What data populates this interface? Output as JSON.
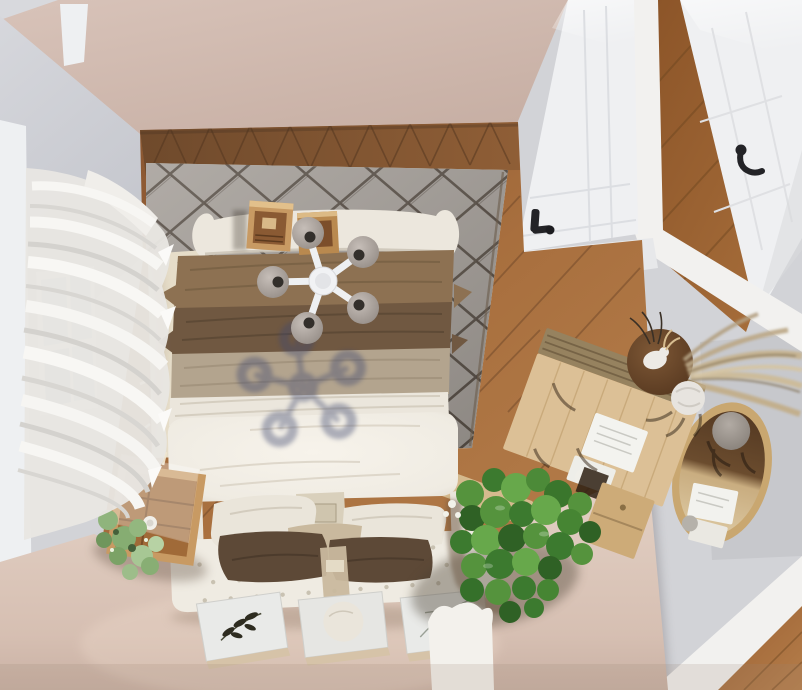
{
  "scene": {
    "view": "top-down 3d render of a bedroom",
    "colors": {
      "outside_floor": "#d2d3d7",
      "outside_floor_light": "#c7c8cc",
      "outside_shadow": "#a7a6aa",
      "wall_band": "#f2f1ef",
      "north_wall": "#cfb9ae",
      "left_wall": "#cdced5",
      "window_frame": "#eef0f2",
      "window_glass": "#a9c3d8",
      "curtain": "#e8e6e2",
      "wood_floor": "#9c6234",
      "wood_floor_dark": "#6f4a2c",
      "hall_wood": "#9a6030",
      "rug_grey": "#a49e98",
      "rug_cream": "#e6ddc9",
      "rug_pattern": "#3f342a",
      "door_white": "#eff0f2",
      "handle_black": "#232327",
      "duvet_white": "#f2eee6",
      "sheet_white": "#ebe6dc",
      "blanket_medium": "#8d7152",
      "blanket_dark": "#705841",
      "blanket_taupe": "#b3a48e",
      "pillow_white": "#eae5da",
      "pillow_brown": "#5d4937",
      "pillow_tan": "#c9b99e",
      "bench_white": "#efebe2",
      "floor_pink": "#ddc8bb",
      "crate_wood": "#c89a63",
      "crate_dark": "#8a5a33",
      "desk_wood": "#dcc096",
      "desk_band": "#96825f",
      "drawer_wood": "#cdab78",
      "table_dark": "#6b4a2e",
      "oval_rim": "#c9a770",
      "cushion_grey": "#a49d97",
      "plant_dark": "#2f6125",
      "plant_mid": "#3c7a2f",
      "plant_light": "#67a84b",
      "succulent": "#8fb47c",
      "pampas": "#c6b28e",
      "chandelier_white": "#f1f2f4",
      "disc_hole": "#332f2b",
      "shadow_blue": "#3f4870",
      "frame_tan": "#d6c3a8",
      "print_face": "#e9eae8",
      "print_ink": "#2e2c20",
      "cloth_white": "#f3f1ec"
    },
    "objects": [
      "north wall",
      "bedroom door",
      "hallway door",
      "door lever handles",
      "left wall",
      "window",
      "sheer curtains",
      "herringbone wood floor",
      "berber rug",
      "bed",
      "footboard roll",
      "layered blankets",
      "duvet",
      "pillows",
      "tufted bench headboard",
      "belt strap",
      "pendant chandelier",
      "chandelier shadow",
      "decor crates",
      "crate nightstand",
      "glass frame",
      "succulent",
      "potted plant",
      "botanical prints",
      "writing desk",
      "desk papers",
      "desk chair",
      "drawer unit",
      "round side table",
      "antler decor",
      "pampas grass",
      "oval mat",
      "hallway wood floor"
    ]
  }
}
